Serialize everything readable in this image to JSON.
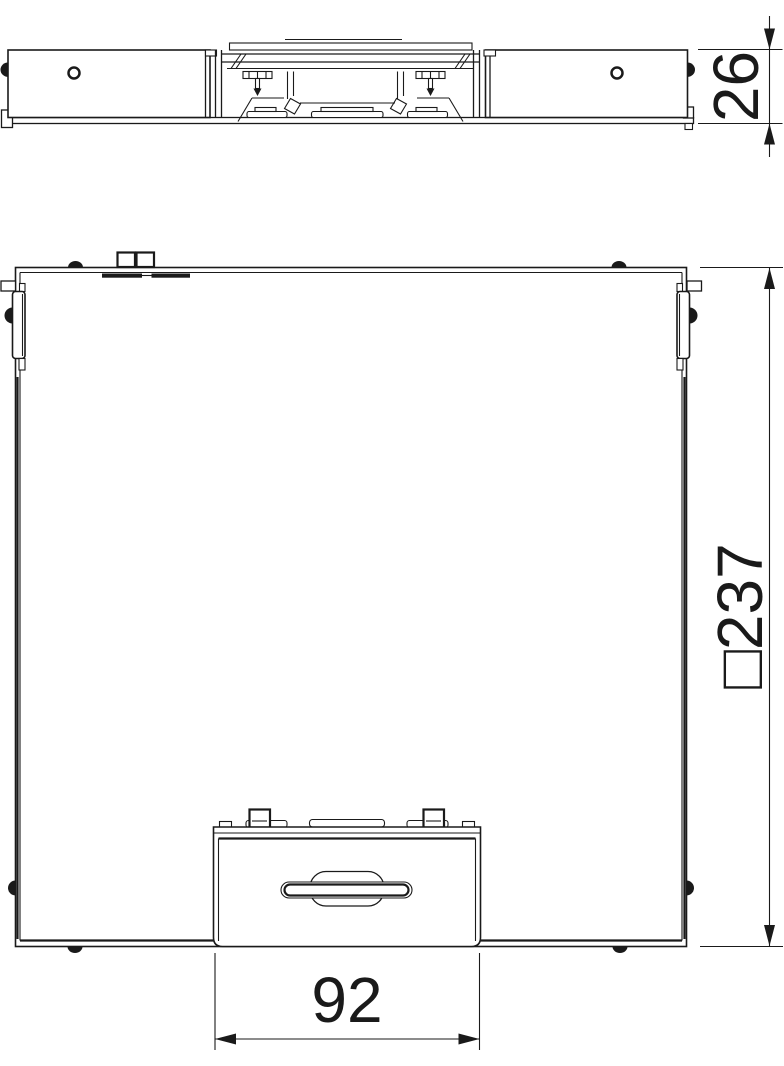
{
  "page": {
    "background_color": "#ffffff"
  },
  "drawing": {
    "line_color": "#1a1a1a",
    "views": [
      {
        "name": "side-elevation",
        "dimensions": [
          {
            "label": "26"
          }
        ]
      },
      {
        "name": "plan-view",
        "dimensions": [
          {
            "label": "□237"
          },
          {
            "label": "92"
          }
        ]
      }
    ]
  }
}
